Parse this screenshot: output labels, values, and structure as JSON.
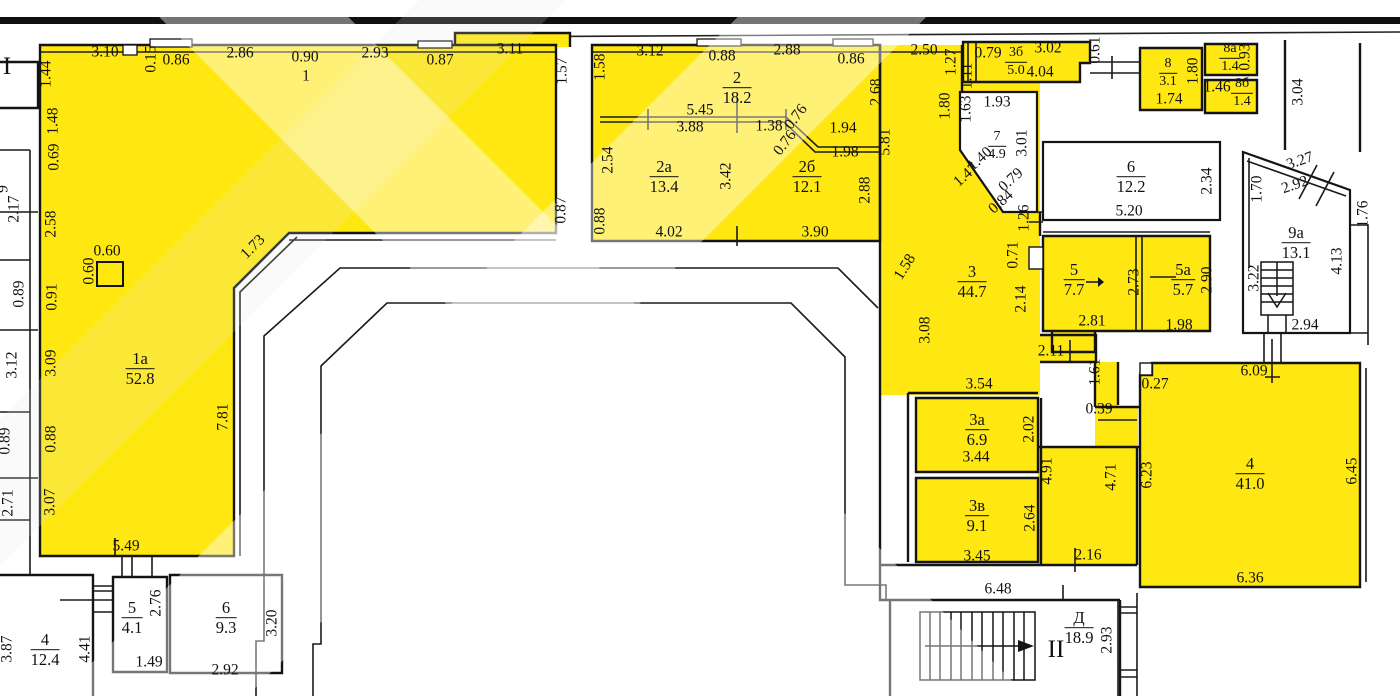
{
  "meta": {
    "type": "floor-plan",
    "floor_mark_left": "I",
    "floor_mark_stairs": "II"
  },
  "colors": {
    "highlight_yellow": "#ffe711",
    "wall_line": "#141414",
    "paper": "#ffffff"
  },
  "rooms": [
    {
      "num": "1а",
      "area": "52.8",
      "x": 140,
      "y": 369
    },
    {
      "num": "2",
      "area": "18.2",
      "x": 737,
      "y": 88
    },
    {
      "num": "2а",
      "area": "13.4",
      "x": 664,
      "y": 177
    },
    {
      "num": "2б",
      "area": "12.1",
      "x": 807,
      "y": 177
    },
    {
      "num": "3",
      "area": "44.7",
      "x": 972,
      "y": 282
    },
    {
      "num": "3а",
      "area": "6.9",
      "x": 977,
      "y": 430
    },
    {
      "num": "3б",
      "area": "5.0",
      "x": 1016,
      "y": 62,
      "small": true
    },
    {
      "num": "3в",
      "area": "9.1",
      "x": 977,
      "y": 516
    },
    {
      "num": "4",
      "area": "41.0",
      "x": 1250,
      "y": 474
    },
    {
      "num": "4",
      "area": "12.4",
      "x": 45,
      "y": 650
    },
    {
      "num": "5",
      "area": "4.1",
      "x": 132,
      "y": 618
    },
    {
      "num": "5",
      "area": "7.7",
      "x": 1074,
      "y": 280
    },
    {
      "num": "5а",
      "area": "5.7",
      "x": 1183,
      "y": 280
    },
    {
      "num": "6",
      "area": "9.3",
      "x": 226,
      "y": 618
    },
    {
      "num": "6",
      "area": "12.2",
      "x": 1131,
      "y": 177
    },
    {
      "num": "7",
      "area": "4.9",
      "x": 997,
      "y": 146,
      "small": true
    },
    {
      "num": "8",
      "area": "3.1",
      "x": 1168,
      "y": 73,
      "small": true
    },
    {
      "num": "8а",
      "area": "1.4",
      "x": 1230,
      "y": 58,
      "small": true
    },
    {
      "num": "8б",
      "area": "1.4",
      "x": 1242,
      "y": 93,
      "small": true
    },
    {
      "num": "9а",
      "area": "13.1",
      "x": 1296,
      "y": 243
    },
    {
      "num": "Д",
      "area": "18.9",
      "x": 1079,
      "y": 628
    }
  ],
  "romans": [
    {
      "t": "I",
      "x": 7,
      "y": 67
    },
    {
      "t": "II",
      "x": 1056,
      "y": 650
    }
  ],
  "dims": [
    {
      "t": "3.10",
      "x": 105,
      "y": 52
    },
    {
      "t": "0.15",
      "x": 151,
      "y": 59,
      "r": -90
    },
    {
      "t": "0.86",
      "x": 176,
      "y": 60
    },
    {
      "t": "2.86",
      "x": 240,
      "y": 53
    },
    {
      "t": "0.90",
      "x": 305,
      "y": 57
    },
    {
      "t": "1",
      "x": 306,
      "y": 76
    },
    {
      "t": "2.93",
      "x": 375,
      "y": 53
    },
    {
      "t": "0.87",
      "x": 440,
      "y": 60
    },
    {
      "t": "3.11",
      "x": 510,
      "y": 49
    },
    {
      "t": "1.57",
      "x": 562,
      "y": 71,
      "r": -90
    },
    {
      "t": "1.58",
      "x": 600,
      "y": 67,
      "r": -90
    },
    {
      "t": "3.12",
      "x": 650,
      "y": 51
    },
    {
      "t": "0.88",
      "x": 722,
      "y": 56
    },
    {
      "t": "2.88",
      "x": 787,
      "y": 50
    },
    {
      "t": "0.86",
      "x": 851,
      "y": 59
    },
    {
      "t": "2.50",
      "x": 924,
      "y": 50
    },
    {
      "t": "1.27",
      "x": 951,
      "y": 62,
      "r": -90
    },
    {
      "t": "0.79",
      "x": 988,
      "y": 53
    },
    {
      "t": "1.11",
      "x": 967,
      "y": 76,
      "r": -90
    },
    {
      "t": "3.02",
      "x": 1048,
      "y": 48
    },
    {
      "t": "4.04",
      "x": 1040,
      "y": 72
    },
    {
      "t": "0.61",
      "x": 1095,
      "y": 50,
      "r": -90
    },
    {
      "t": "1.74",
      "x": 1169,
      "y": 99
    },
    {
      "t": "1.80",
      "x": 1193,
      "y": 71,
      "r": -90
    },
    {
      "t": "0.93",
      "x": 1245,
      "y": 57,
      "r": -90
    },
    {
      "t": "1.46",
      "x": 1217,
      "y": 87
    },
    {
      "t": "3.04",
      "x": 1298,
      "y": 92,
      "r": -90
    },
    {
      "t": "1.80",
      "x": 945,
      "y": 106,
      "r": -90
    },
    {
      "t": "1.63",
      "x": 966,
      "y": 109,
      "r": -90
    },
    {
      "t": "1.93",
      "x": 997,
      "y": 102
    },
    {
      "t": "2.68",
      "x": 876,
      "y": 92,
      "r": -90
    },
    {
      "t": "5.81",
      "x": 885,
      "y": 142,
      "r": -90
    },
    {
      "t": "2.88",
      "x": 865,
      "y": 190,
      "r": -90
    },
    {
      "t": "5.45",
      "x": 700,
      "y": 110
    },
    {
      "t": "3.88",
      "x": 690,
      "y": 127
    },
    {
      "t": "1.38",
      "x": 769,
      "y": 126
    },
    {
      "t": "0.76",
      "x": 796,
      "y": 117,
      "r": -52
    },
    {
      "t": "0.76",
      "x": 785,
      "y": 143,
      "r": -52
    },
    {
      "t": "1.94",
      "x": 843,
      "y": 128
    },
    {
      "t": "1.98",
      "x": 845,
      "y": 152
    },
    {
      "t": "2.54",
      "x": 608,
      "y": 160,
      "r": -90
    },
    {
      "t": "3.42",
      "x": 726,
      "y": 176,
      "r": -90
    },
    {
      "t": "0.87",
      "x": 561,
      "y": 210,
      "r": -90
    },
    {
      "t": "0.88",
      "x": 600,
      "y": 221,
      "r": -90
    },
    {
      "t": "4.02",
      "x": 669,
      "y": 232
    },
    {
      "t": "3.90",
      "x": 815,
      "y": 232
    },
    {
      "t": "3.01",
      "x": 1022,
      "y": 143,
      "r": -90
    },
    {
      "t": "1.40",
      "x": 980,
      "y": 159,
      "r": -42
    },
    {
      "t": "1.47",
      "x": 966,
      "y": 175,
      "r": -42
    },
    {
      "t": "0.79",
      "x": 1011,
      "y": 180,
      "r": -42
    },
    {
      "t": "0.84",
      "x": 1001,
      "y": 202,
      "r": -42
    },
    {
      "t": "1.26",
      "x": 1024,
      "y": 218,
      "r": -90
    },
    {
      "t": "5.20",
      "x": 1129,
      "y": 211
    },
    {
      "t": "2.34",
      "x": 1207,
      "y": 181,
      "r": -90
    },
    {
      "t": "1.70",
      "x": 1257,
      "y": 189,
      "r": -90
    },
    {
      "t": "3.27",
      "x": 1300,
      "y": 161,
      "r": -19
    },
    {
      "t": "2.92",
      "x": 1295,
      "y": 185,
      "r": -19
    },
    {
      "t": "1.76",
      "x": 1363,
      "y": 214,
      "r": -90
    },
    {
      "t": "1.58",
      "x": 905,
      "y": 267,
      "r": -58
    },
    {
      "t": "3.08",
      "x": 925,
      "y": 330,
      "r": -90
    },
    {
      "t": "0.71",
      "x": 1013,
      "y": 255,
      "r": -90
    },
    {
      "t": "2.14",
      "x": 1021,
      "y": 299,
      "r": -90
    },
    {
      "t": "2.73",
      "x": 1134,
      "y": 282,
      "r": -90
    },
    {
      "t": "2.90",
      "x": 1207,
      "y": 280,
      "r": -90
    },
    {
      "t": "2.81",
      "x": 1092,
      "y": 321
    },
    {
      "t": "1.98",
      "x": 1179,
      "y": 325
    },
    {
      "t": "2.11",
      "x": 1051,
      "y": 351
    },
    {
      "t": "1.61",
      "x": 1095,
      "y": 372,
      "r": -90
    },
    {
      "t": "0.39",
      "x": 1099,
      "y": 409
    },
    {
      "t": "0.27",
      "x": 1155,
      "y": 384
    },
    {
      "t": "6.09",
      "x": 1254,
      "y": 371
    },
    {
      "t": "2.94",
      "x": 1305,
      "y": 325
    },
    {
      "t": "3.22",
      "x": 1254,
      "y": 278,
      "r": -90
    },
    {
      "t": "4.13",
      "x": 1337,
      "y": 261,
      "r": -90
    },
    {
      "t": "3.54",
      "x": 979,
      "y": 384
    },
    {
      "t": "2.02",
      "x": 1029,
      "y": 429,
      "r": -90
    },
    {
      "t": "3.44",
      "x": 976,
      "y": 457
    },
    {
      "t": "4.91",
      "x": 1047,
      "y": 471,
      "r": -90
    },
    {
      "t": "2.64",
      "x": 1030,
      "y": 518,
      "r": -90
    },
    {
      "t": "3.45",
      "x": 977,
      "y": 556
    },
    {
      "t": "2.16",
      "x": 1088,
      "y": 555
    },
    {
      "t": "4.71",
      "x": 1111,
      "y": 477,
      "r": -90
    },
    {
      "t": "6.23",
      "x": 1147,
      "y": 475,
      "r": -90
    },
    {
      "t": "6.45",
      "x": 1352,
      "y": 471,
      "r": -90
    },
    {
      "t": "6.36",
      "x": 1250,
      "y": 578
    },
    {
      "t": "6.48",
      "x": 998,
      "y": 589
    },
    {
      "t": "2.93",
      "x": 1107,
      "y": 640,
      "r": -90
    },
    {
      "t": "1.44",
      "x": 46,
      "y": 74,
      "r": -90
    },
    {
      "t": "1.48",
      "x": 53,
      "y": 121,
      "r": -90
    },
    {
      "t": "0.69",
      "x": 54,
      "y": 157,
      "r": -90
    },
    {
      "t": "2.17",
      "x": 14,
      "y": 209,
      "r": -90
    },
    {
      "t": "2.58",
      "x": 51,
      "y": 224,
      "r": -90
    },
    {
      "t": "0.89",
      "x": 19,
      "y": 294,
      "r": -90
    },
    {
      "t": "0.91",
      "x": 52,
      "y": 297,
      "r": -90
    },
    {
      "t": "0.60",
      "x": 107,
      "y": 251
    },
    {
      "t": "0.60",
      "x": 89,
      "y": 271,
      "r": -90
    },
    {
      "t": "3.12",
      "x": 12,
      "y": 365,
      "r": -90
    },
    {
      "t": "3.09",
      "x": 51,
      "y": 363,
      "r": -90
    },
    {
      "t": "0.89",
      "x": 5,
      "y": 441,
      "r": -90
    },
    {
      "t": "0.88",
      "x": 51,
      "y": 439,
      "r": -90
    },
    {
      "t": "2.71",
      "x": 8,
      "y": 503,
      "r": -90
    },
    {
      "t": "3.07",
      "x": 50,
      "y": 502,
      "r": -90
    },
    {
      "t": "1.73",
      "x": 253,
      "y": 247,
      "r": -45
    },
    {
      "t": "7.81",
      "x": 223,
      "y": 417,
      "r": -90
    },
    {
      "t": "5.49",
      "x": 126,
      "y": 546
    },
    {
      "t": "2.76",
      "x": 156,
      "y": 603,
      "r": -90
    },
    {
      "t": "3.20",
      "x": 272,
      "y": 623,
      "r": -90
    },
    {
      "t": "1.49",
      "x": 149,
      "y": 662
    },
    {
      "t": "2.92",
      "x": 225,
      "y": 670
    },
    {
      "t": "3.87",
      "x": 7,
      "y": 649,
      "r": -90
    },
    {
      "t": "4.41",
      "x": 85,
      "y": 649,
      "r": -90
    },
    {
      "t": "9",
      "x": 3,
      "y": 189,
      "r": -90
    }
  ]
}
